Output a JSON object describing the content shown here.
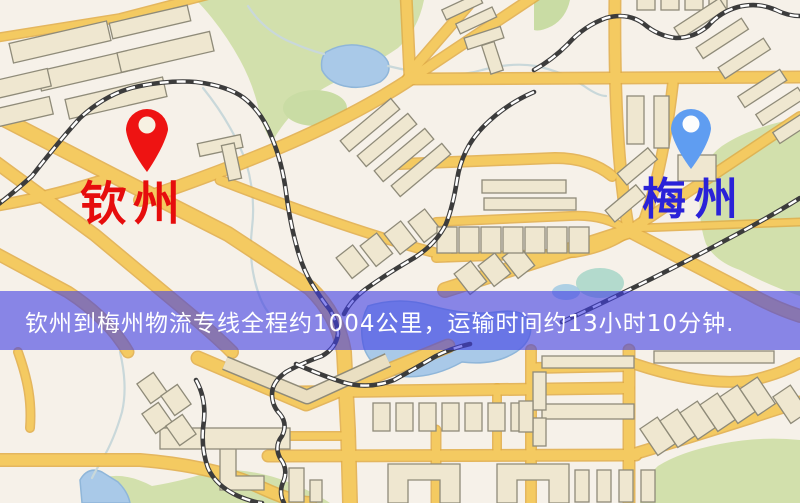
{
  "map": {
    "origin_marker": {
      "label": "钦州",
      "label_color": "#e60d0d",
      "pin_color": "#ee1312"
    },
    "destination_marker": {
      "label": "梅州",
      "label_color": "#2a22d8",
      "pin_color": "#5f9df1"
    },
    "banner": {
      "text": "钦州到梅州物流专线全程约1004公里，运输时间约13小时10分钟.",
      "background": "rgba(63,61,228,0.6)",
      "text_color": "#ffffff"
    },
    "palette": {
      "background": "#f6f1e9",
      "road": "#f4ca61",
      "road_casing": "#e0ab45",
      "building": "#efe7d0",
      "building_outline": "#8f8b79",
      "park": "#d2e0ac",
      "water": "#a9c9e8",
      "railway": "#3c3c3c",
      "railway_dash": "#ffffff"
    }
  }
}
